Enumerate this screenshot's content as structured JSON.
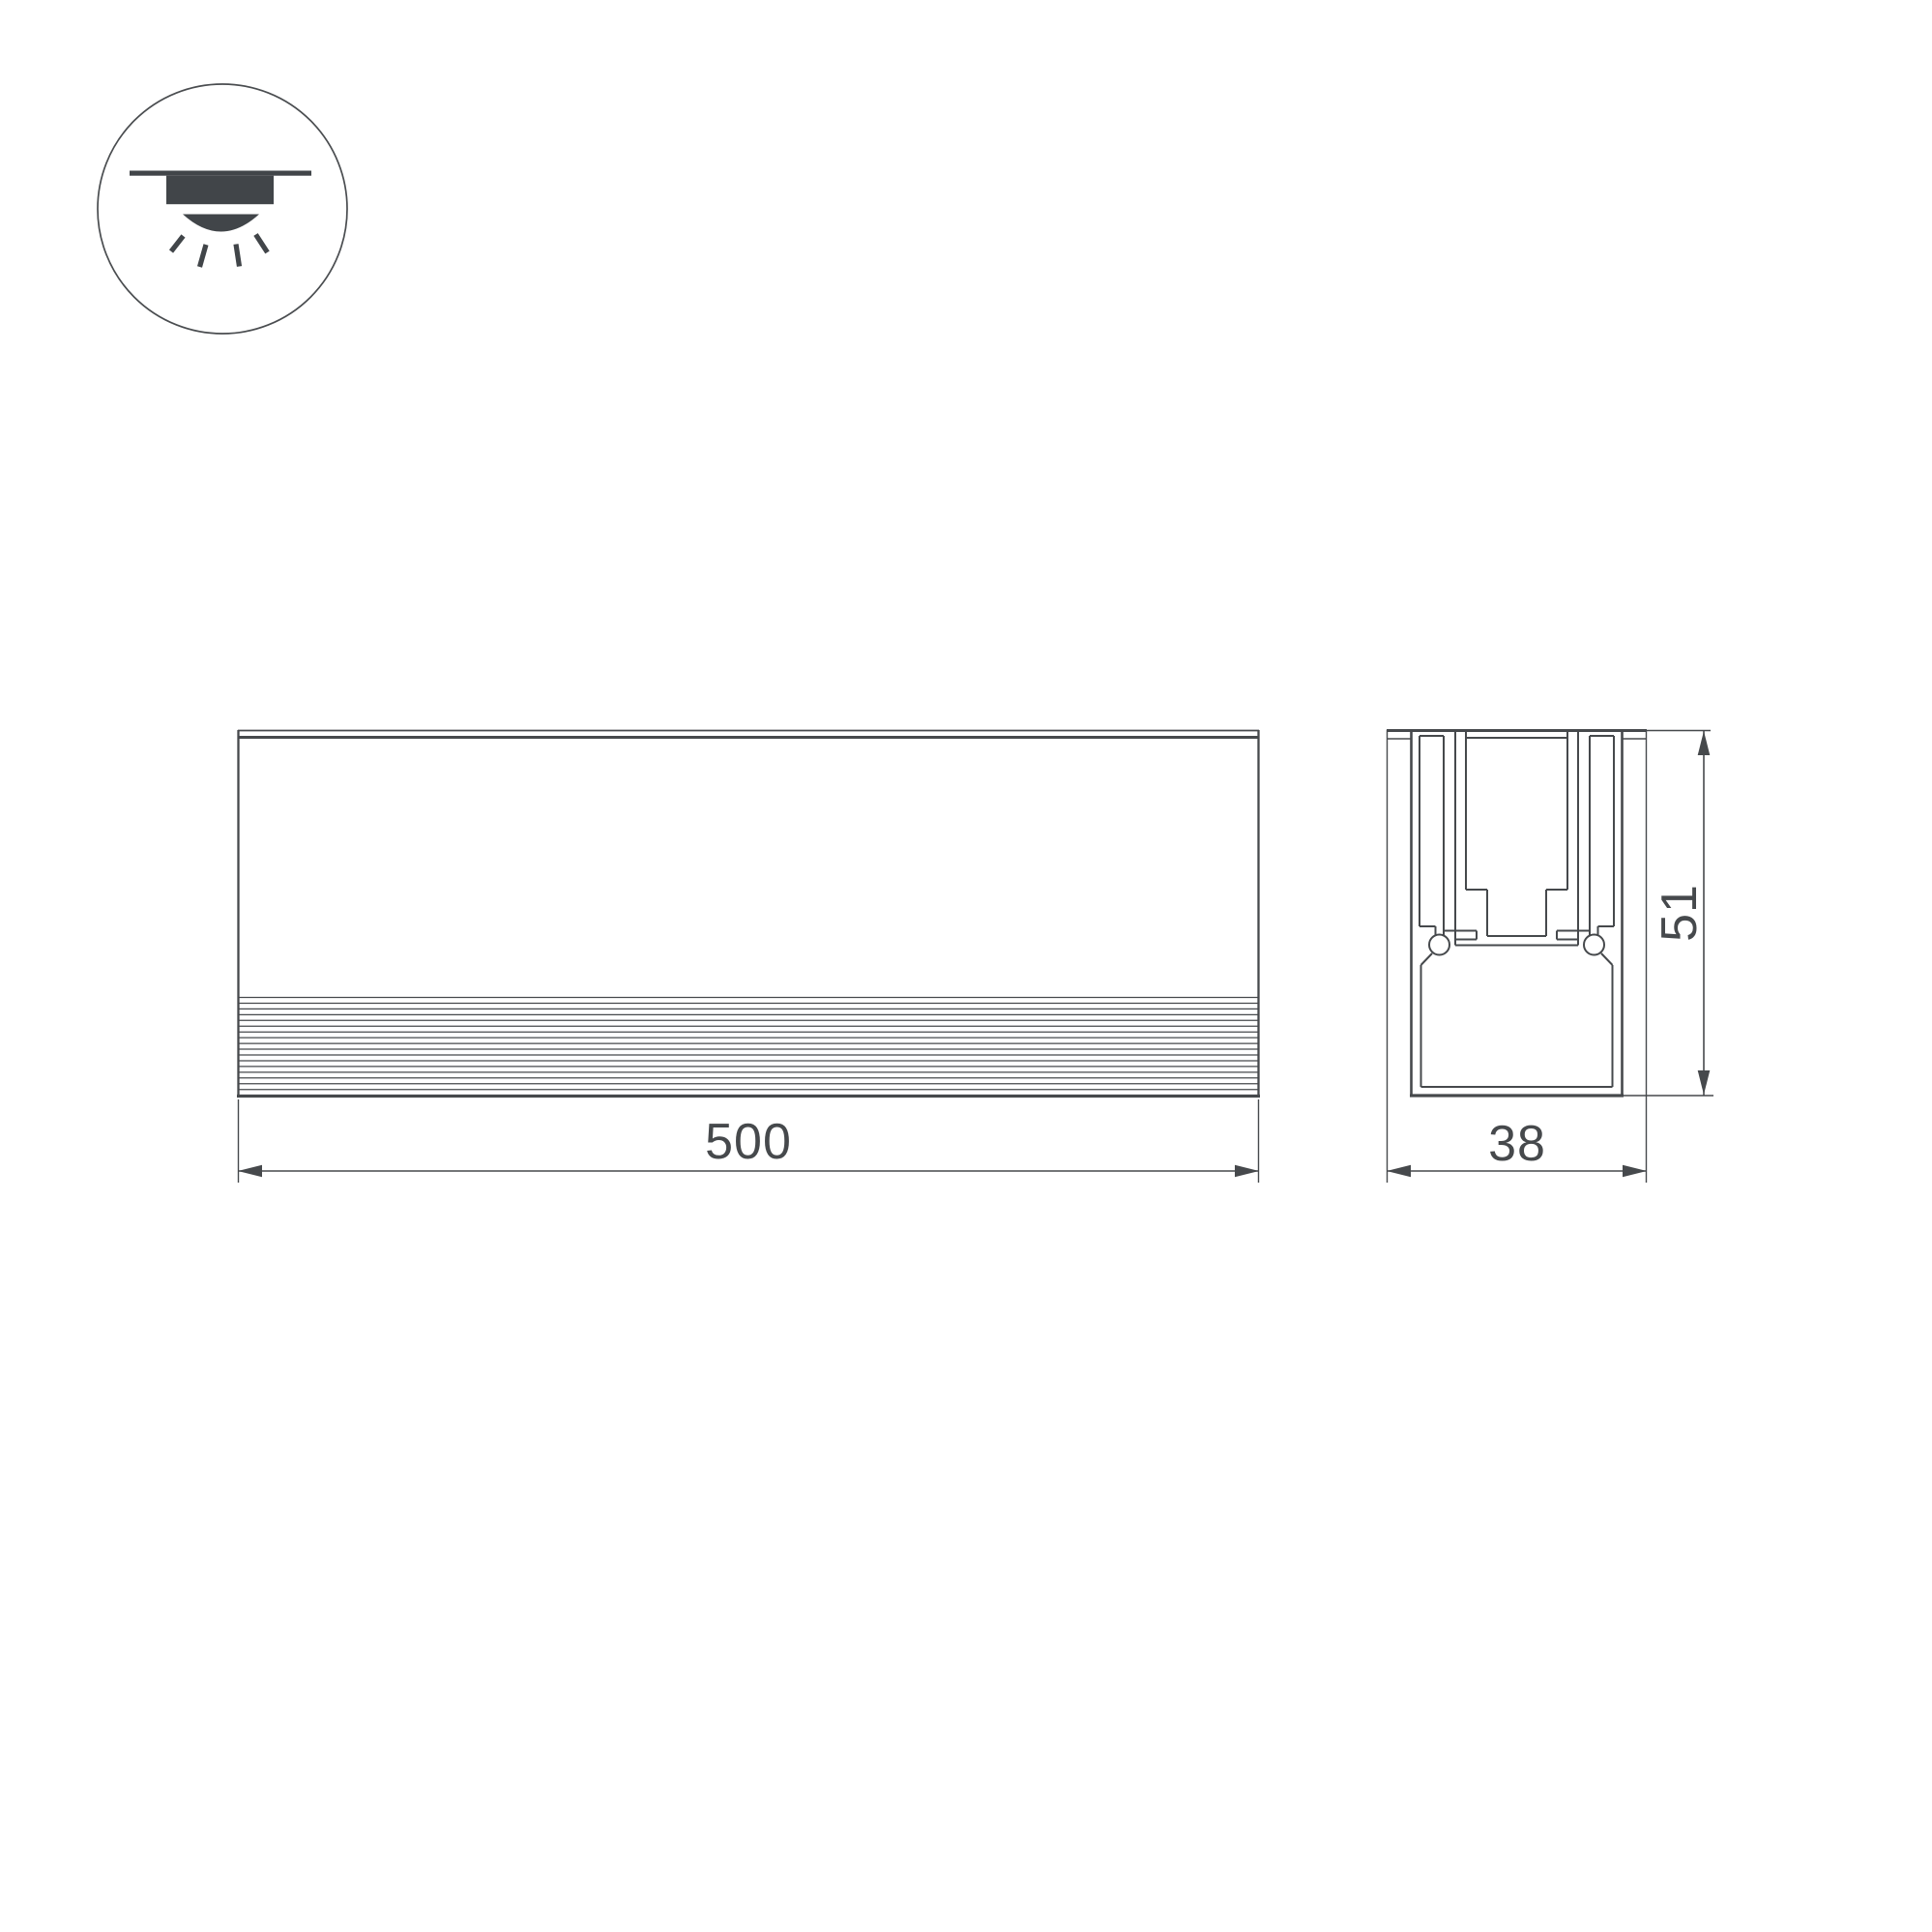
{
  "meta": {
    "type": "technical-dimension-drawing",
    "background": "#ffffff",
    "line_color": "#46494c",
    "icon_fill": "#414549"
  },
  "mounting_icon": {
    "name": "recessed-ceiling-light",
    "meaning": "recessed / built-in mounting"
  },
  "views": {
    "front_view": {
      "dimension_length": "500"
    },
    "section_view": {
      "dimension_width": "38",
      "dimension_height": "51"
    }
  }
}
